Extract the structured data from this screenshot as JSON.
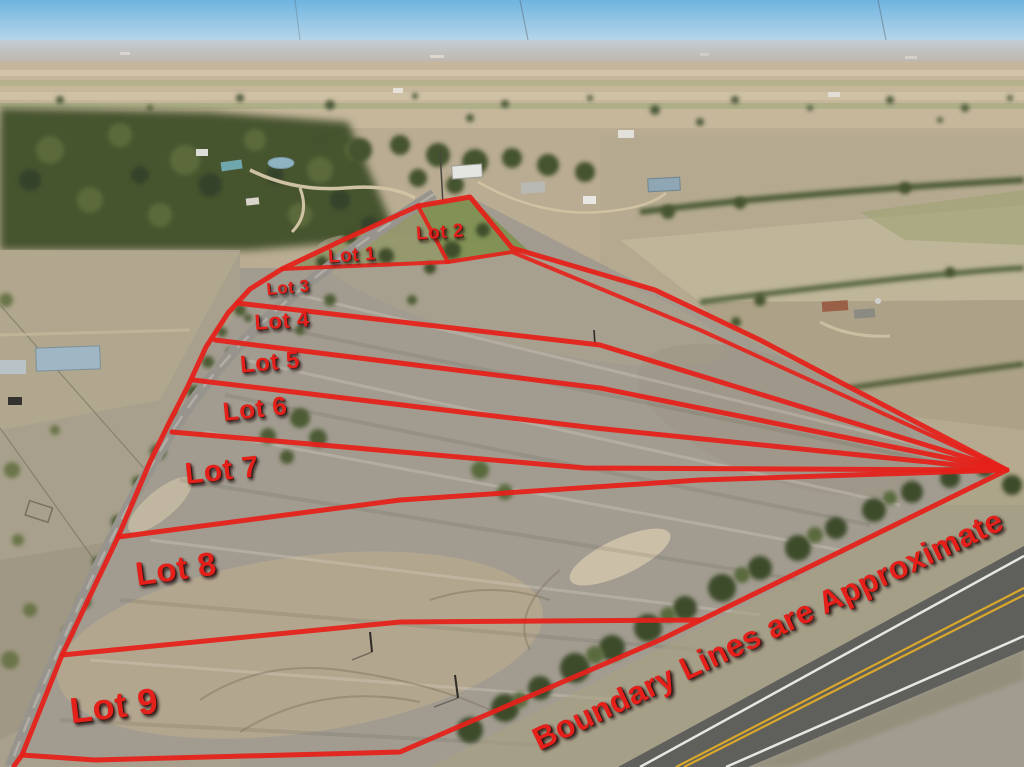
{
  "overlay": {
    "disclaimer": "Boundary Lines are Approximate",
    "lots": [
      {
        "id": "lot-1",
        "label": "Lot 1"
      },
      {
        "id": "lot-2",
        "label": "Lot 2"
      },
      {
        "id": "lot-3",
        "label": "Lot 3"
      },
      {
        "id": "lot-4",
        "label": "Lot 4"
      },
      {
        "id": "lot-5",
        "label": "Lot 5"
      },
      {
        "id": "lot-6",
        "label": "Lot 6"
      },
      {
        "id": "lot-7",
        "label": "Lot 7"
      },
      {
        "id": "lot-8",
        "label": "Lot 8"
      },
      {
        "id": "lot-9",
        "label": "Lot 9"
      }
    ]
  },
  "colors": {
    "boundary_red": "#e5201a",
    "sky": "#79bbe2",
    "field_gray": "#a29c90",
    "tree_dark": "#44522e",
    "road_gray": "#96948c",
    "highway_gray": "#5f5f5c",
    "stripe_yellow": "#d9a72b"
  }
}
